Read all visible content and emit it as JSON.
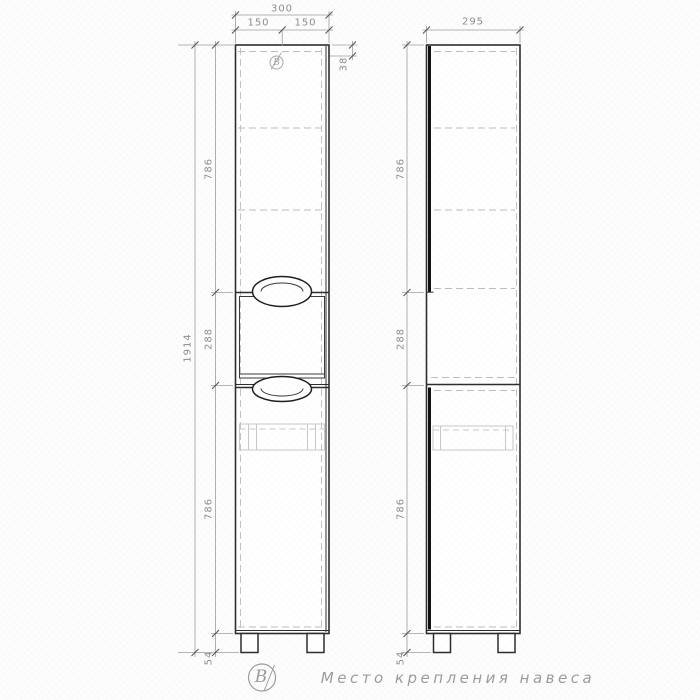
{
  "drawing": {
    "front": {
      "total_width": "300",
      "left_half": "150",
      "right_half": "150",
      "hanger_offset": "38",
      "overall_height": "1914",
      "top_section": "786",
      "middle_section": "288",
      "bottom_section": "786",
      "leg_height": "54",
      "hanger_marker": "В"
    },
    "side": {
      "depth": "295",
      "top_section": "786",
      "middle_section": "288",
      "bottom_section": "786",
      "leg_height": "54"
    },
    "legend": {
      "marker": "В",
      "caption": "Место крепления навеса"
    }
  }
}
